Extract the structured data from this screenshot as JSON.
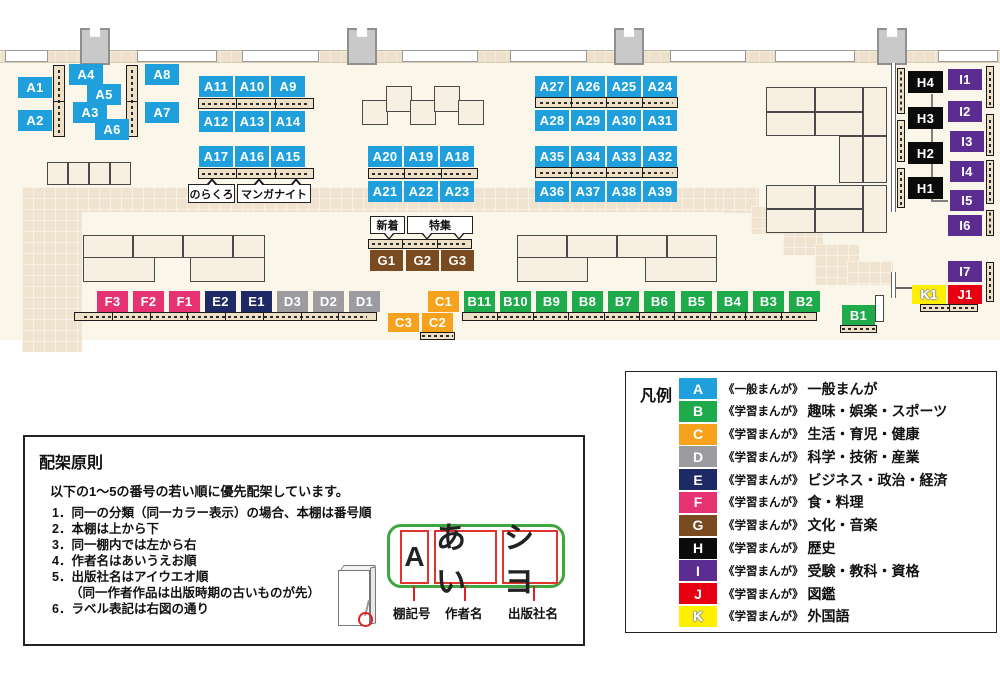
{
  "map": {
    "shelves": {
      "A1": "A1",
      "A2": "A2",
      "A3": "A3",
      "A4": "A4",
      "A5": "A5",
      "A6": "A6",
      "A7": "A7",
      "A8": "A8",
      "A9": "A9",
      "A10": "A10",
      "A11": "A11",
      "A12": "A12",
      "A13": "A13",
      "A14": "A14",
      "A15": "A15",
      "A16": "A16",
      "A17": "A17",
      "A18": "A18",
      "A19": "A19",
      "A20": "A20",
      "A21": "A21",
      "A22": "A22",
      "A23": "A23",
      "A24": "A24",
      "A25": "A25",
      "A26": "A26",
      "A27": "A27",
      "A28": "A28",
      "A29": "A29",
      "A30": "A30",
      "A31": "A31",
      "A32": "A32",
      "A33": "A33",
      "A34": "A34",
      "A35": "A35",
      "A36": "A36",
      "A37": "A37",
      "A38": "A38",
      "A39": "A39",
      "B1": "B1",
      "B2": "B2",
      "B3": "B3",
      "B4": "B4",
      "B5": "B5",
      "B6": "B6",
      "B7": "B7",
      "B8": "B8",
      "B9": "B9",
      "B10": "B10",
      "B11": "B11",
      "C1": "C1",
      "C2": "C2",
      "C3": "C3",
      "D1": "D1",
      "D2": "D2",
      "D3": "D3",
      "E1": "E1",
      "E2": "E2",
      "F1": "F1",
      "F2": "F2",
      "F3": "F3",
      "G1": "G1",
      "G2": "G2",
      "G3": "G3",
      "H1": "H1",
      "H2": "H2",
      "H3": "H3",
      "H4": "H4",
      "I1": "I1",
      "I2": "I2",
      "I3": "I3",
      "I4": "I4",
      "I5": "I5",
      "I6": "I6",
      "I7": "I7",
      "J1": "J1",
      "K1": "K1"
    },
    "callouts": {
      "norakuro": "のらくろ",
      "manga_night": "マンガナイト",
      "new_arrival": "新着",
      "feature": "特集"
    },
    "colors": {
      "A": "#1fa0dc",
      "B": "#1faa4b",
      "C": "#f6a21c",
      "D": "#9c9ca0",
      "E": "#1e2a66",
      "F": "#e73272",
      "G": "#7a4a21",
      "H": "#0b0b0b",
      "I": "#5c2d91",
      "J": "#e60012",
      "K": "#ffef00"
    }
  },
  "legend": {
    "title": "凡例",
    "items": [
      {
        "letter": "A",
        "type": "《一般まんが》",
        "category": "一般まんが",
        "color": "#1fa0dc"
      },
      {
        "letter": "B",
        "type": "《学習まんが》",
        "category": "趣味・娯楽・スポーツ",
        "color": "#1faa4b"
      },
      {
        "letter": "C",
        "type": "《学習まんが》",
        "category": "生活・育児・健康",
        "color": "#f6a21c"
      },
      {
        "letter": "D",
        "type": "《学習まんが》",
        "category": "科学・技術・産業",
        "color": "#9c9ca0"
      },
      {
        "letter": "E",
        "type": "《学習まんが》",
        "category": "ビジネス・政治・経済",
        "color": "#1e2a66"
      },
      {
        "letter": "F",
        "type": "《学習まんが》",
        "category": "食・料理",
        "color": "#e73272"
      },
      {
        "letter": "G",
        "type": "《学習まんが》",
        "category": "文化・音楽",
        "color": "#7a4a21"
      },
      {
        "letter": "H",
        "type": "《学習まんが》",
        "category": "歴史",
        "color": "#0b0b0b"
      },
      {
        "letter": "I",
        "type": "《学習まんが》",
        "category": "受験・教科・資格",
        "color": "#5c2d91"
      },
      {
        "letter": "J",
        "type": "《学習まんが》",
        "category": "図鑑",
        "color": "#e60012"
      },
      {
        "letter": "K",
        "type": "《学習まんが》",
        "category": "外国語",
        "color": "#ffef00"
      }
    ]
  },
  "principles": {
    "title": "配架原則",
    "intro": "以下の1～5の番号の若い順に優先配架しています。",
    "items": [
      "1．同一の分類（同一カラー表示）の場合、本棚は番号順",
      "2．本棚は上から下",
      "3．同一棚内では左から右",
      "4．作者名はあいうえお順",
      "5．出版社名はアイウエオ順",
      "（同一作者作品は出版時期の古いものが先）",
      "6．ラベル表記は右図の通り"
    ],
    "label_diagram": {
      "shelf_code": "A",
      "author": "あい",
      "publisher": "シヨ",
      "caption_shelf_code": "棚記号",
      "caption_author": "作者名",
      "caption_publisher": "出版社名"
    }
  }
}
